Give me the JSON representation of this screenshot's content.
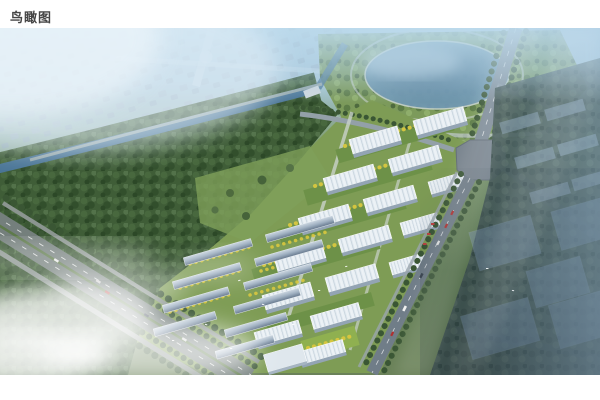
{
  "page": {
    "title": "鸟瞰图"
  },
  "figure": {
    "type": "architectural-aerial-rendering",
    "alt": "住宅小区鸟瞰效果图：中部为白色高层住宅与联排洋房，左侧为河道与密林，上方为湖泊公园与城市道路，右侧为半透明规划建筑，左下为高速公路与云雾",
    "palette": {
      "sky_haze": "#b7d6e8",
      "lake_water": "#5d87a4",
      "river_water": "#4a7596",
      "forest_green": "#3f5d37",
      "lawn_green": "#7e9c55",
      "autumn_yellow": "#d9c83f",
      "building_white": "#e9eff4",
      "roof_gray": "#67798e",
      "road_gray": "#7b8783",
      "ghost_blue": "#7d96ab",
      "dark_corner": "#22303c",
      "mist_white": "#ffffff"
    }
  }
}
